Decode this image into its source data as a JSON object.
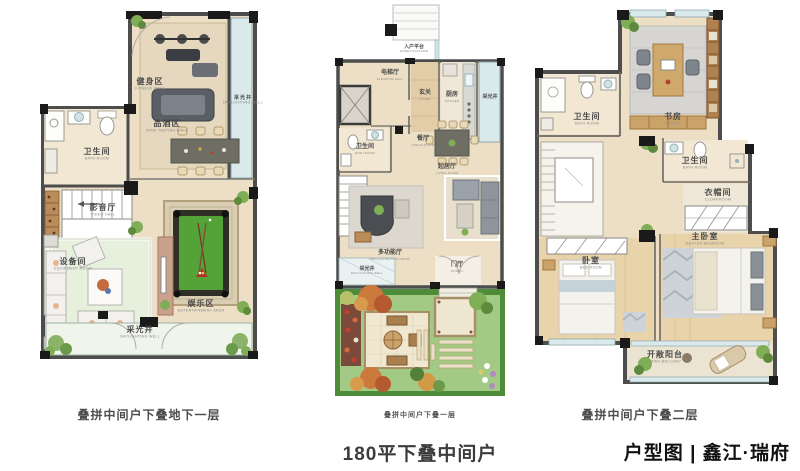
{
  "plans": [
    {
      "caption": "叠拼中间户下叠地下一层",
      "rooms": [
        {
          "zh": "健身区",
          "en": "FITNESS AREA"
        },
        {
          "zh": "采光井",
          "en": "DAYLIGHTING WELL"
        },
        {
          "zh": "卫生间",
          "en": "BATH ROOM"
        },
        {
          "zh": "品酒区",
          "en": "WINE TASTING AREA"
        },
        {
          "zh": "设备间",
          "en": "EQUIPMENT ROOM"
        },
        {
          "zh": "影音厅",
          "en": "VIDEO HALL"
        },
        {
          "zh": "娱乐区",
          "en": "ENTERTAINMENT AREA"
        },
        {
          "zh": "采光井",
          "en": "DAYLIGHTING WELL"
        }
      ]
    },
    {
      "caption": "叠拼中间户下叠一层",
      "rooms": [
        {
          "zh": "入户平台",
          "en": "HOME PLATFORM"
        },
        {
          "zh": "电梯厅",
          "en": "ELEVATOR HALL"
        },
        {
          "zh": "玄关",
          "en": "FOYER"
        },
        {
          "zh": "厨房",
          "en": "KITCHEN"
        },
        {
          "zh": "采光井",
          "en": "DAYLIGHTING WELL"
        },
        {
          "zh": "卫生间",
          "en": "BATH ROOM"
        },
        {
          "zh": "餐厅",
          "en": "DINING ROOM"
        },
        {
          "zh": "起居厅",
          "en": "LIVING ROOM"
        },
        {
          "zh": "多功能厅",
          "en": "MULTI-FUNCTION ROOM"
        },
        {
          "zh": "采光井",
          "en": "DAYLIGHTING WELL"
        },
        {
          "zh": "门厅",
          "en": "PORCH"
        }
      ]
    },
    {
      "caption": "叠拼中间户下叠二层",
      "rooms": [
        {
          "zh": "书房",
          "en": "STUDY"
        },
        {
          "zh": "卫生间",
          "en": "BATH ROOM"
        },
        {
          "zh": "卫生间",
          "en": "BATH ROOM"
        },
        {
          "zh": "衣帽间",
          "en": "CLOAKROOM"
        },
        {
          "zh": "主卧室",
          "en": "MASTER BEDROOM"
        },
        {
          "zh": "卧室",
          "en": "BED ROOM"
        },
        {
          "zh": "开敞阳台",
          "en": "OPEN BALCONY"
        }
      ]
    }
  ],
  "footer": {
    "title": "180平下叠中间户",
    "brand": "户型图 | 鑫江·瑞府"
  },
  "colors": {
    "wall": "#4d4d4d",
    "column": "#1a1a1a",
    "floor": "#ecdfc6",
    "window": "#d9e9ec",
    "lawn": "#a3ca84",
    "hedge": "#4f8c39",
    "billiard_green": "#53a339",
    "caption_text": "#4d4d4d"
  }
}
